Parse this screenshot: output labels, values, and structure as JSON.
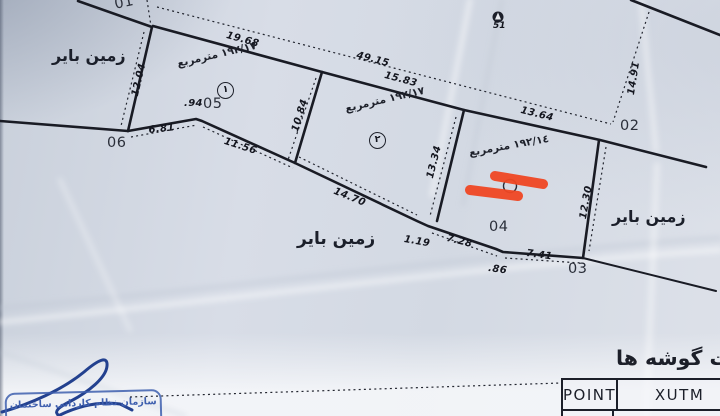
{
  "colors": {
    "paper": "#d4dae3",
    "ink": "#1b1e28",
    "highlight_red": "#ef4723",
    "stamp_blue": "#3e5fae",
    "signature_blue": "#23418f"
  },
  "survey_map": {
    "dimension_labels": [
      {
        "text": "19.68",
        "x": 228,
        "y": 30,
        "rot": 16
      },
      {
        "text": "49.15",
        "x": 358,
        "y": 50,
        "rot": 15
      },
      {
        "text": "15.83",
        "x": 386,
        "y": 70,
        "rot": 15
      },
      {
        "text": "13.64",
        "x": 522,
        "y": 105,
        "rot": 14
      },
      {
        "text": "14.91",
        "x": 626,
        "y": 94,
        "rot": -81
      },
      {
        "text": "12.04",
        "x": 130,
        "y": 95,
        "rot": -77
      },
      {
        "text": "6.81",
        "x": 148,
        "y": 125,
        "rot": -6
      },
      {
        "text": ".94",
        "x": 184,
        "y": 98,
        "rot": 0
      },
      {
        "text": "11.56",
        "x": 226,
        "y": 136,
        "rot": 18
      },
      {
        "text": "10.84",
        "x": 290,
        "y": 130,
        "rot": -73
      },
      {
        "text": "13.34",
        "x": 425,
        "y": 177,
        "rot": -76
      },
      {
        "text": "14.70",
        "x": 336,
        "y": 186,
        "rot": 22
      },
      {
        "text": "1.19",
        "x": 405,
        "y": 234,
        "rot": 10
      },
      {
        "text": "7.28",
        "x": 448,
        "y": 233,
        "rot": 14
      },
      {
        "text": ".86",
        "x": 489,
        "y": 263,
        "rot": 8
      },
      {
        "text": "7.41",
        "x": 527,
        "y": 248,
        "rot": 8
      },
      {
        "text": "12.30",
        "x": 578,
        "y": 218,
        "rot": -80
      }
    ],
    "corner_point_labels": [
      {
        "text": "01",
        "x": 113,
        "y": -3,
        "rot": -12
      },
      {
        "text": "02",
        "x": 620,
        "y": 118
      },
      {
        "text": "03",
        "x": 568,
        "y": 261
      },
      {
        "text": "04",
        "x": 489,
        "y": 219
      },
      {
        "text": "05",
        "x": 203,
        "y": 96
      },
      {
        "text": "06",
        "x": 107,
        "y": 135
      }
    ],
    "land_use_labels": [
      {
        "text": "زمین بایر",
        "x": 52,
        "y": 46,
        "size": 16,
        "dir": "rtl"
      },
      {
        "text": "زمین بایر",
        "x": 297,
        "y": 229,
        "size": 17,
        "dir": "rtl"
      },
      {
        "text": "زمین بایر",
        "x": 612,
        "y": 207,
        "size": 16,
        "dir": "rtl"
      }
    ],
    "area_labels": [
      {
        "text": "١٩٢/١٧ مترمربع",
        "x": 176,
        "y": 58,
        "rot": -13,
        "circle_text": "١",
        "circle_x": 217,
        "circle_y": 82
      },
      {
        "text": "١٩٢/١٧ مترمربع",
        "x": 344,
        "y": 103,
        "rot": -13,
        "circle_text": "٢",
        "circle_x": 369,
        "circle_y": 132
      },
      {
        "text": "١٩٢/١٤ مترمربع",
        "x": 468,
        "y": 147,
        "rot": -10
      }
    ],
    "benchmark": {
      "text": "51",
      "x": 493,
      "y": 21
    }
  },
  "coordinates_table": {
    "title_visible": "ات گوشه ها",
    "headers": [
      "POINT",
      "XUTM"
    ]
  },
  "stamp": {
    "text": "سازمان نظام کاردانی ساختمان"
  }
}
